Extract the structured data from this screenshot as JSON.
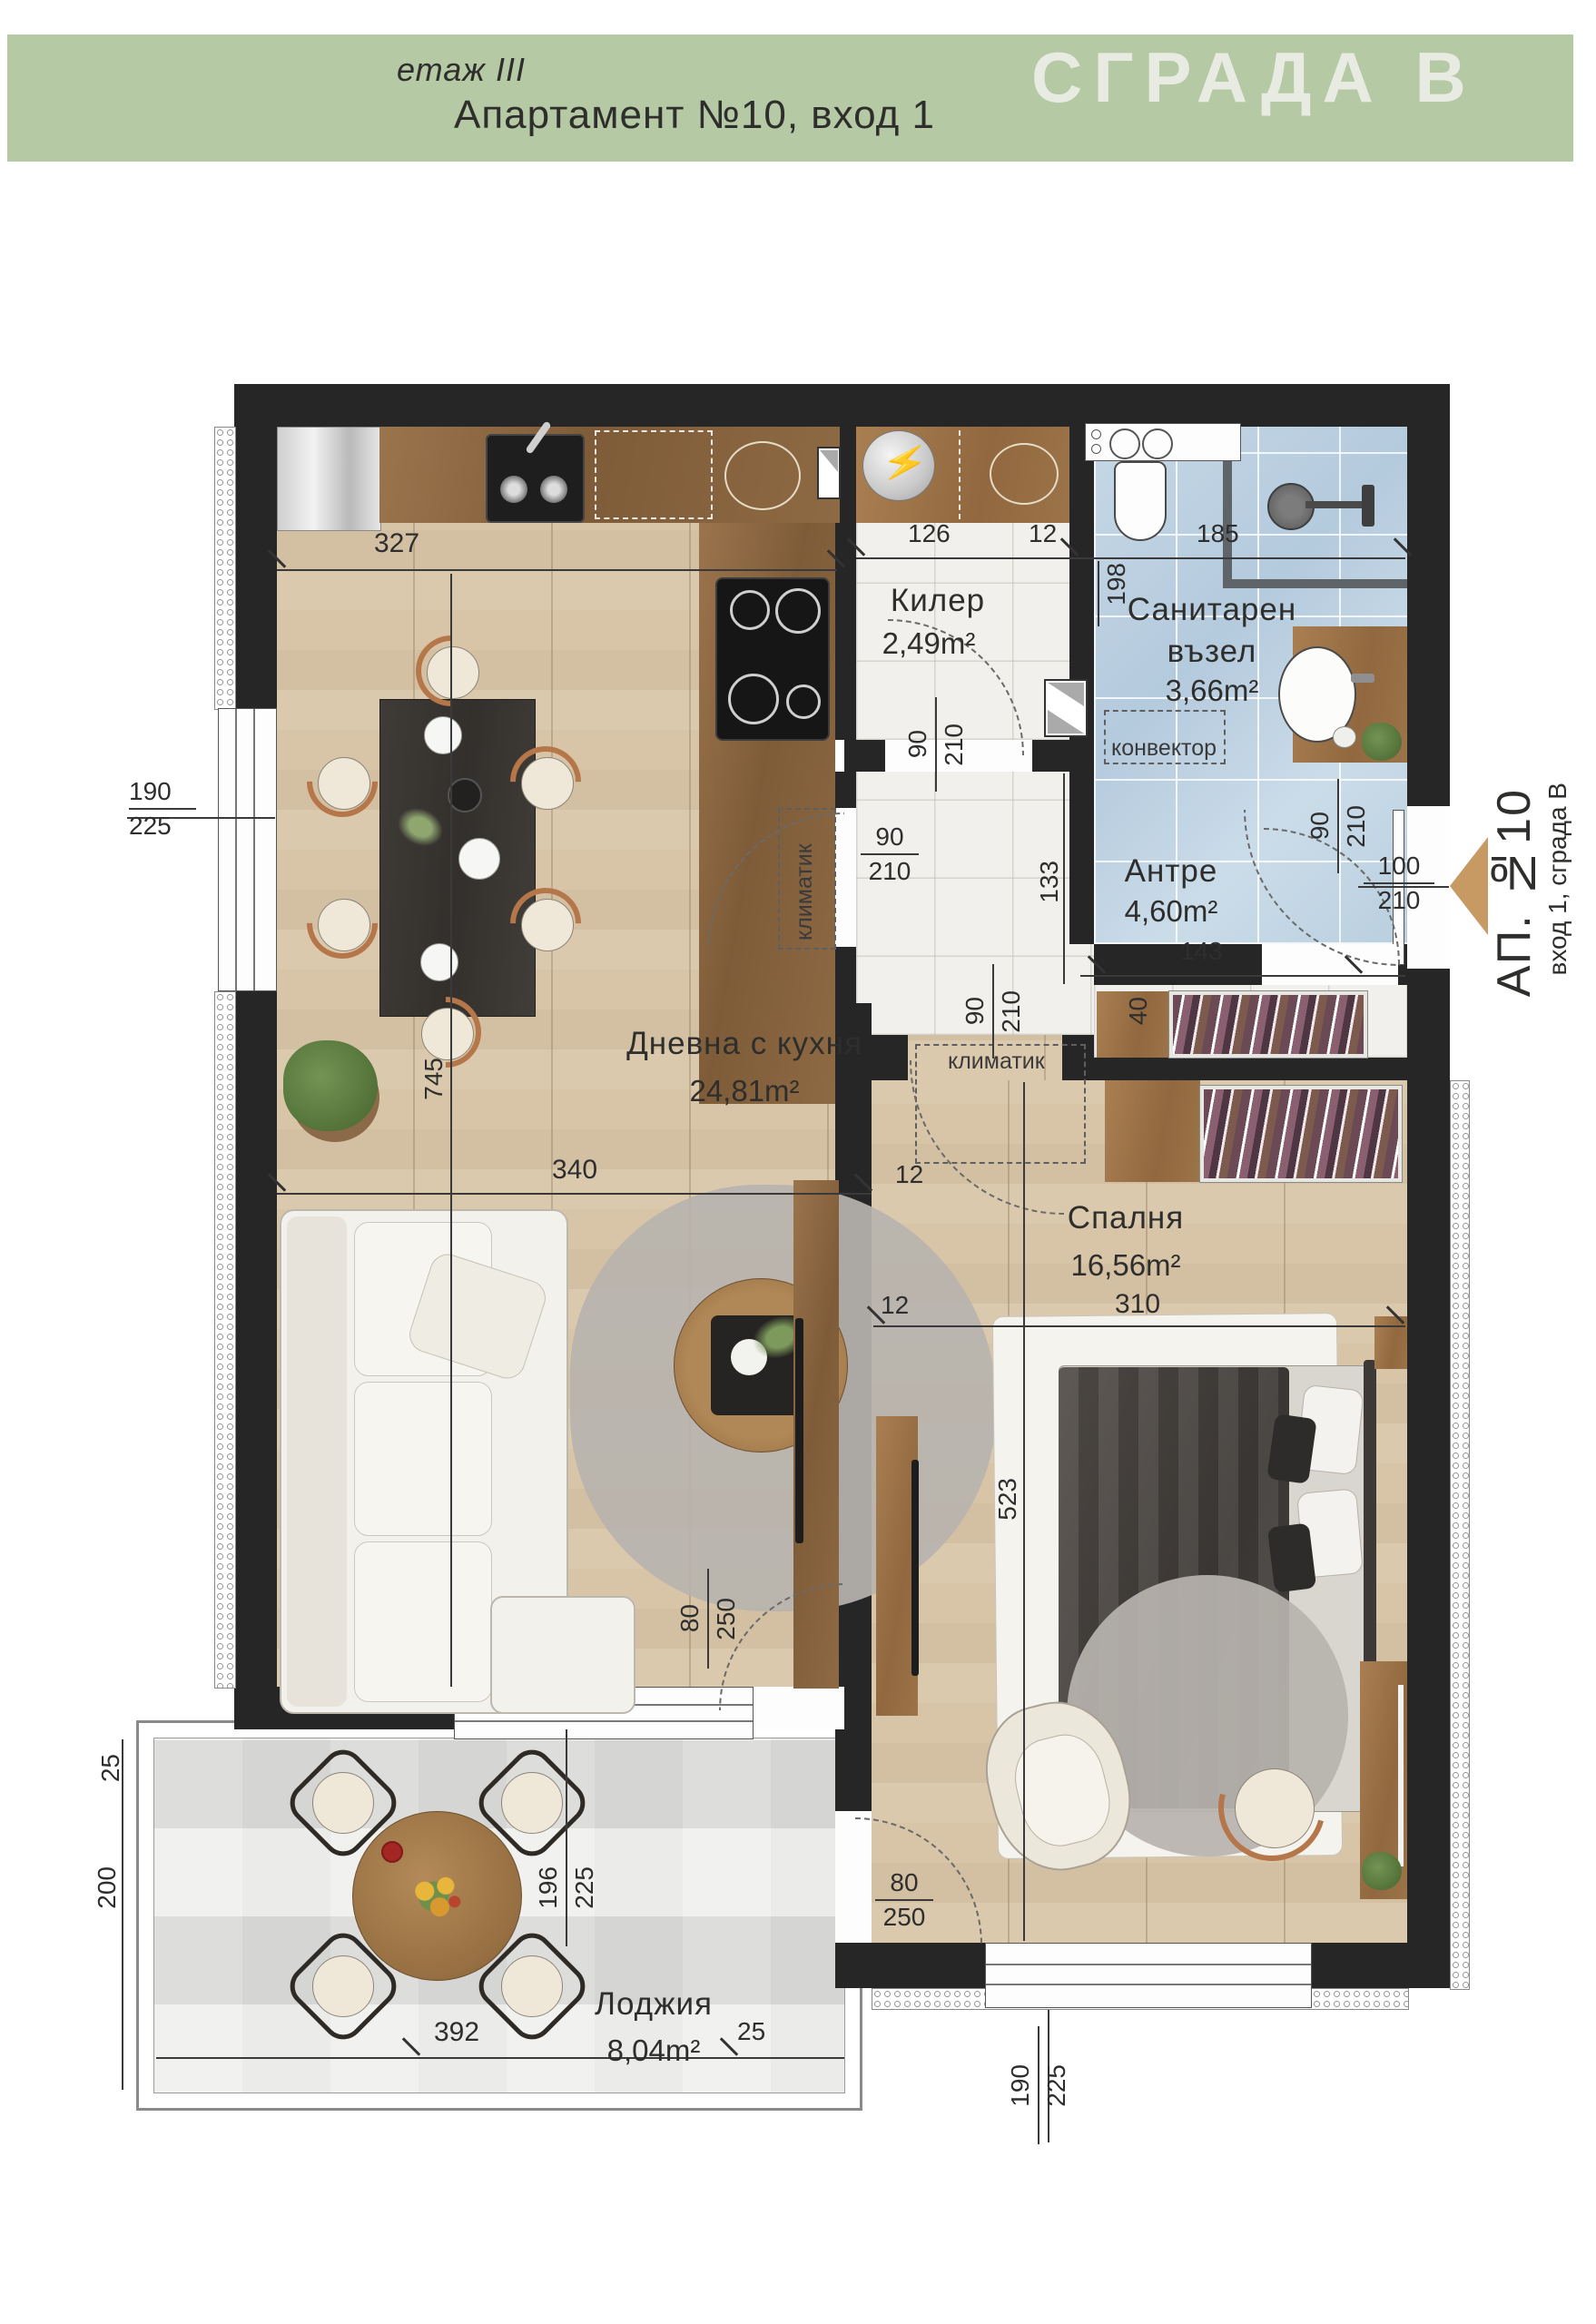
{
  "header": {
    "floor_label": "етаж III",
    "apartment_title": "Апартамент №10, вход 1",
    "building_label": "СГРАДА В"
  },
  "entrance_tag": {
    "main": "АП. №10",
    "sub": "вход 1, сграда В"
  },
  "rooms": {
    "living": {
      "name": "Дневна с кухня",
      "area": "24,81m²"
    },
    "kiler": {
      "name": "Килер",
      "area": "2,49m²"
    },
    "bath": {
      "name1": "Санитарен",
      "name2": "възел",
      "area": "3,66m²"
    },
    "antre": {
      "name": "Антре",
      "area": "4,60m²"
    },
    "bedroom": {
      "name": "Спалня",
      "area": "16,56m²"
    },
    "loggia": {
      "name": "Лоджия",
      "area": "8,04m²"
    }
  },
  "annotations": {
    "klimatik": "климатик",
    "konvektor": "конвектор"
  },
  "dims": {
    "kitchen_width": "327",
    "kiler_width": "126",
    "kiler_wall": "12",
    "bath_width": "185",
    "bath_depth": "198",
    "left_window": {
      "num": "190",
      "den": "225"
    },
    "kiler_door": {
      "num": "90",
      "den": "210"
    },
    "antre_opening": {
      "num": "90",
      "den": "210"
    },
    "bath_door": {
      "num": "90",
      "den": "210"
    },
    "bedroom_door": {
      "num": "90",
      "den": "210"
    },
    "entry_door": {
      "num": "100",
      "den": "210"
    },
    "living_length": "745",
    "living_width": "340",
    "living_wall": "12",
    "antre_depth": "133",
    "antre_width": "143",
    "wardrobe_depth": "40",
    "bedroom_width": "310",
    "bedroom_wall": "12",
    "bedroom_length": "523",
    "living_loggia_door": {
      "num": "80",
      "den": "250"
    },
    "living_window": {
      "num": "196",
      "den": "225"
    },
    "bedroom_loggia_door": {
      "num": "80",
      "den": "250"
    },
    "loggia_corner": "25",
    "loggia_depth": "200",
    "loggia_width": "392",
    "loggia_right": "25",
    "bedroom_window": {
      "num": "190",
      "den": "225"
    }
  },
  "colors": {
    "accent_green": "#b5c9a4",
    "wall": "#262626",
    "arrow": "#c79a63"
  }
}
